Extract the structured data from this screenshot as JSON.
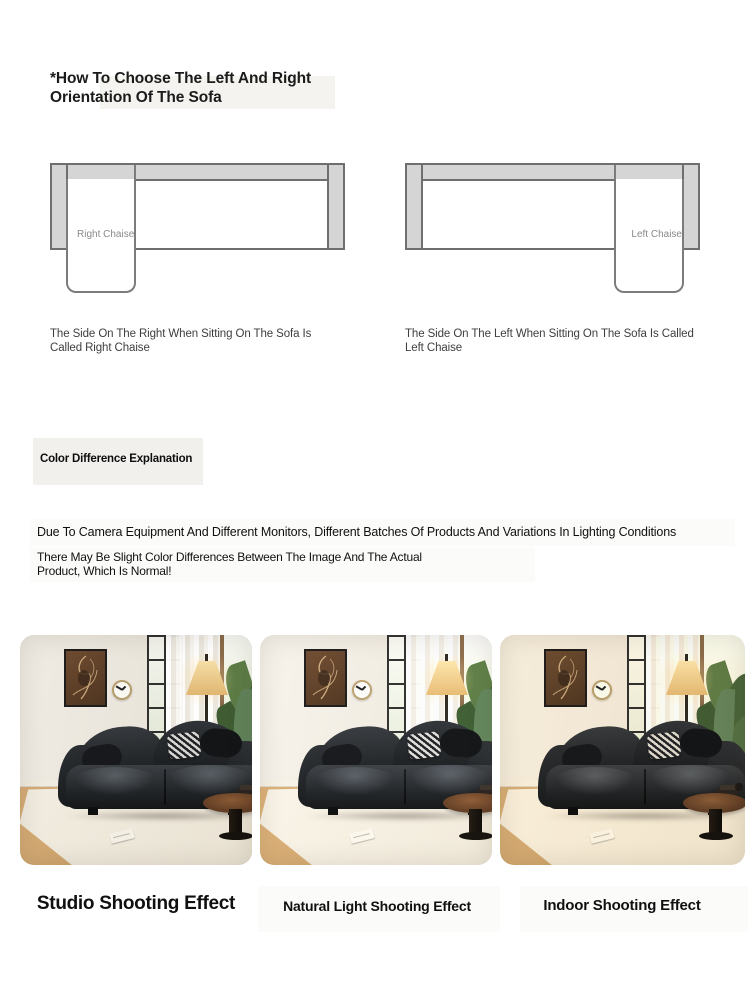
{
  "orientation": {
    "title": "*How To Choose The Left And Right Orientation Of The Sofa",
    "diagrams": [
      {
        "label": "Right Chaise",
        "caption": "The Side On The Right When Sitting On The Sofa Is Called Right Chaise"
      },
      {
        "label": "Left Chaise",
        "caption": "The Side On The Left When Sitting On The Sofa Is Called Left Chaise"
      }
    ]
  },
  "color_difference": {
    "heading": "Color Difference Explanation",
    "line1": "Due To Camera Equipment And Different Monitors, Different Batches Of Products And Variations In Lighting Conditions",
    "line2": "There May Be Slight Color Differences Between The Image And The Actual Product, Which Is Normal!"
  },
  "shooting_effects": [
    {
      "label": "Studio Shooting Effect"
    },
    {
      "label": "Natural Light Shooting Effect"
    },
    {
      "label": "Indoor Shooting Effect"
    }
  ],
  "colors": {
    "page_background": "#ffffff",
    "diagram_fill_gray": "#d5d5d5",
    "diagram_border": "#6f6f6f",
    "diagram_label_gray": "#8a8a8a",
    "caption_text": "#3e3e3e",
    "heading_text": "#0e0e0e",
    "sofa_black": "#1a1c1e",
    "wall_cream": "#eae5db",
    "floor_wood": "#c59c64",
    "lamp_shade": "#e9c486"
  }
}
